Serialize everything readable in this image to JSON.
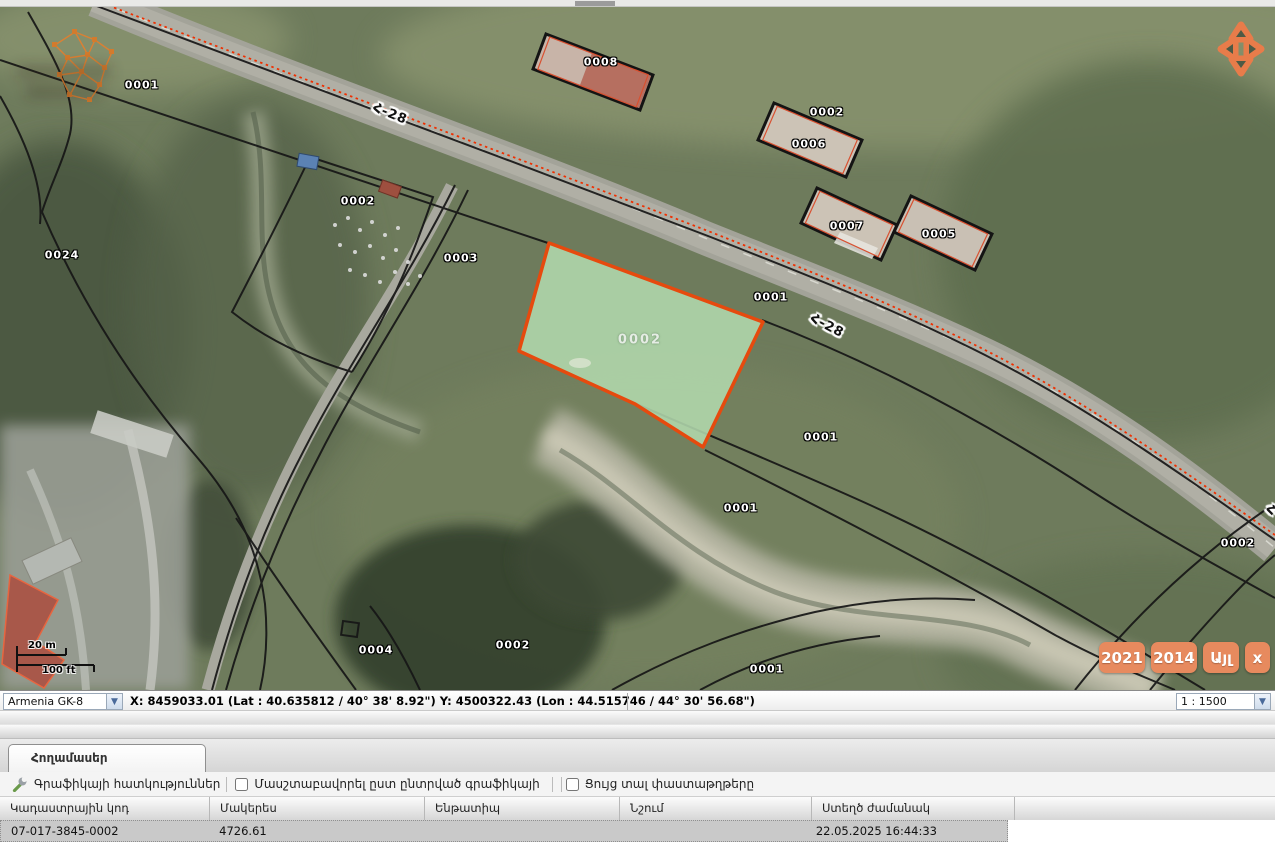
{
  "map": {
    "labels": [
      {
        "text": "0001",
        "x": 142,
        "y": 85,
        "style": "parcel",
        "rot": 0
      },
      {
        "text": "0008",
        "x": 601,
        "y": 62,
        "style": "parcel",
        "rot": 0
      },
      {
        "text": "0002",
        "x": 827,
        "y": 112,
        "style": "parcel",
        "rot": 0
      },
      {
        "text": "0006",
        "x": 809,
        "y": 144,
        "style": "parcel",
        "rot": 0
      },
      {
        "text": "0002",
        "x": 358,
        "y": 201,
        "style": "parcel",
        "rot": 0
      },
      {
        "text": "0007",
        "x": 847,
        "y": 226,
        "style": "parcel",
        "rot": 0
      },
      {
        "text": "0005",
        "x": 939,
        "y": 234,
        "style": "parcel",
        "rot": 0
      },
      {
        "text": "0024",
        "x": 62,
        "y": 255,
        "style": "parcel",
        "rot": 0
      },
      {
        "text": "0003",
        "x": 461,
        "y": 258,
        "style": "parcel",
        "rot": 0
      },
      {
        "text": "0001",
        "x": 771,
        "y": 297,
        "style": "parcel",
        "rot": 0
      },
      {
        "text": "Հ-28",
        "x": 390,
        "y": 114,
        "style": "road",
        "rot": 22
      },
      {
        "text": "Հ-28",
        "x": 827,
        "y": 326,
        "style": "road",
        "rot": 28
      },
      {
        "text": "0002",
        "x": 640,
        "y": 340,
        "style": "selected",
        "rot": 0
      },
      {
        "text": "0001",
        "x": 821,
        "y": 437,
        "style": "parcel",
        "rot": 0
      },
      {
        "text": "0001",
        "x": 741,
        "y": 508,
        "style": "parcel",
        "rot": 0
      },
      {
        "text": "0002",
        "x": 1238,
        "y": 543,
        "style": "parcel",
        "rot": 0
      },
      {
        "text": "0004",
        "x": 376,
        "y": 650,
        "style": "parcel",
        "rot": 0
      },
      {
        "text": "0002",
        "x": 513,
        "y": 645,
        "style": "parcel",
        "rot": 0
      },
      {
        "text": "0001",
        "x": 767,
        "y": 669,
        "style": "parcel",
        "rot": 0
      },
      {
        "text": "Հ-28",
        "x": 1283,
        "y": 516,
        "style": "road",
        "rot": 25
      }
    ],
    "scalebar": {
      "metric": "20 m",
      "imperial": "100 ft"
    },
    "year_buttons": [
      {
        "label": "2021"
      },
      {
        "label": "2014"
      },
      {
        "label": "Այլ"
      },
      {
        "label": "x"
      }
    ]
  },
  "statusbar": {
    "projection": "Armenia GK-8",
    "coordinates": "X: 8459033.01 (Lat : 40.635812 / 40° 38' 8.92\")  Y: 4500322.43 (Lon : 44.515746 / 44° 30' 56.68\")",
    "scale": "1 : 1500"
  },
  "panel": {
    "tab_label": "Հողամասեր",
    "toolbar": {
      "graphics_properties": "Գրաֆիկայի հատկություններ",
      "scale_by_graphic": "Մասշտաբավորել ըստ ընտրված գրաֆիկայի",
      "show_documents": "Ցույց տալ փաստաթղթերը"
    },
    "table": {
      "headers": [
        "Կադաստրային կոդ",
        "Մակերես",
        "Ենթատիպ",
        "Նշում",
        "Ստեղծ ժամանակ"
      ],
      "row": {
        "cadastral_code": "07-017-3845-0002",
        "area": "4726.61",
        "subtype": "",
        "note": "",
        "created": "22.05.2025 16:44:33"
      }
    }
  },
  "colors": {
    "accent_orange": "#e78a5e",
    "parcel_fill": "#b2d8ad",
    "parcel_border": "#e64a0e",
    "route_red": "#ef2f00"
  }
}
